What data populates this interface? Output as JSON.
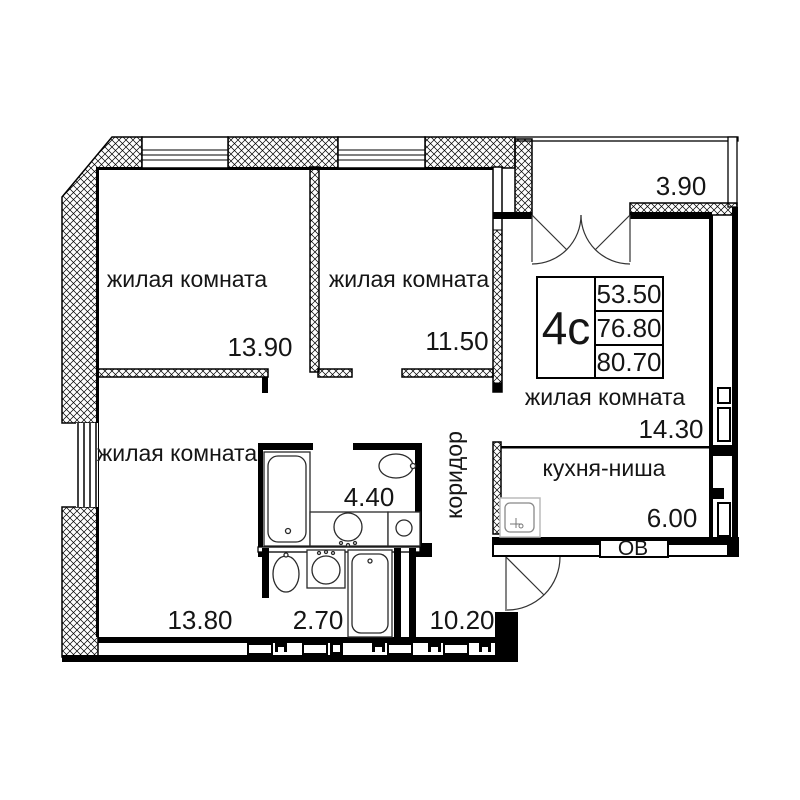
{
  "plan": {
    "type_label": "4с",
    "areas_table": {
      "living_total": "53.50",
      "area_mid": "76.80",
      "area_total": "80.70"
    },
    "rooms": {
      "living1": {
        "name": "жилая комната",
        "area": "13.90"
      },
      "living2": {
        "name": "жилая комната",
        "area": "11.50"
      },
      "living3": {
        "name": "жилая комната",
        "area": "14.30"
      },
      "living4": {
        "name": "жилая комната",
        "area": "13.80"
      },
      "kitchen": {
        "name": "кухня-ниша",
        "area": "6.00"
      },
      "corridor": {
        "name": "коридор",
        "area": "10.20"
      },
      "bathroom": {
        "area": "4.40"
      },
      "wc": {
        "area": "2.70"
      },
      "balcony": {
        "area": "3.90"
      }
    },
    "vent_label": "ОВ",
    "colors": {
      "walls": "#000000",
      "background": "#ffffff",
      "text": "#151515"
    }
  }
}
